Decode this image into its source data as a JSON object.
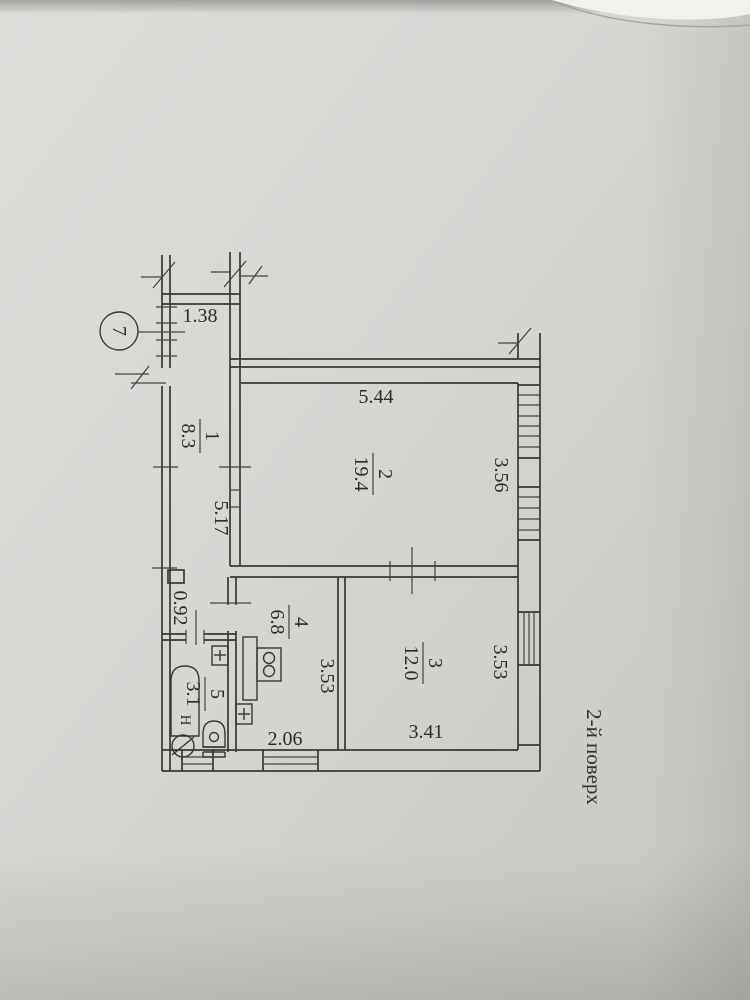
{
  "sheet": {
    "floor_label": "2-й поверх",
    "unit_marker": "7",
    "bath_mark": "Н"
  },
  "rooms": [
    {
      "num": "1",
      "area": "8.3"
    },
    {
      "num": "2",
      "area": "19.4"
    },
    {
      "num": "3",
      "area": "12.0"
    },
    {
      "num": "4",
      "area": "6.8"
    },
    {
      "num": "5",
      "area": "3.1"
    }
  ],
  "dims": {
    "hall_top_width": "1.38",
    "room2_width": "5.44",
    "room2_depth": "3.56",
    "hall_length": "5.17",
    "corridor_width": "0.92",
    "kitchen_depth": "3.53",
    "kitchen_width": "2.06",
    "room3_depth": "3.53",
    "room3_width": "3.41"
  },
  "colors": {
    "paper": "#d7d6d3",
    "ink": "#3a3833"
  }
}
